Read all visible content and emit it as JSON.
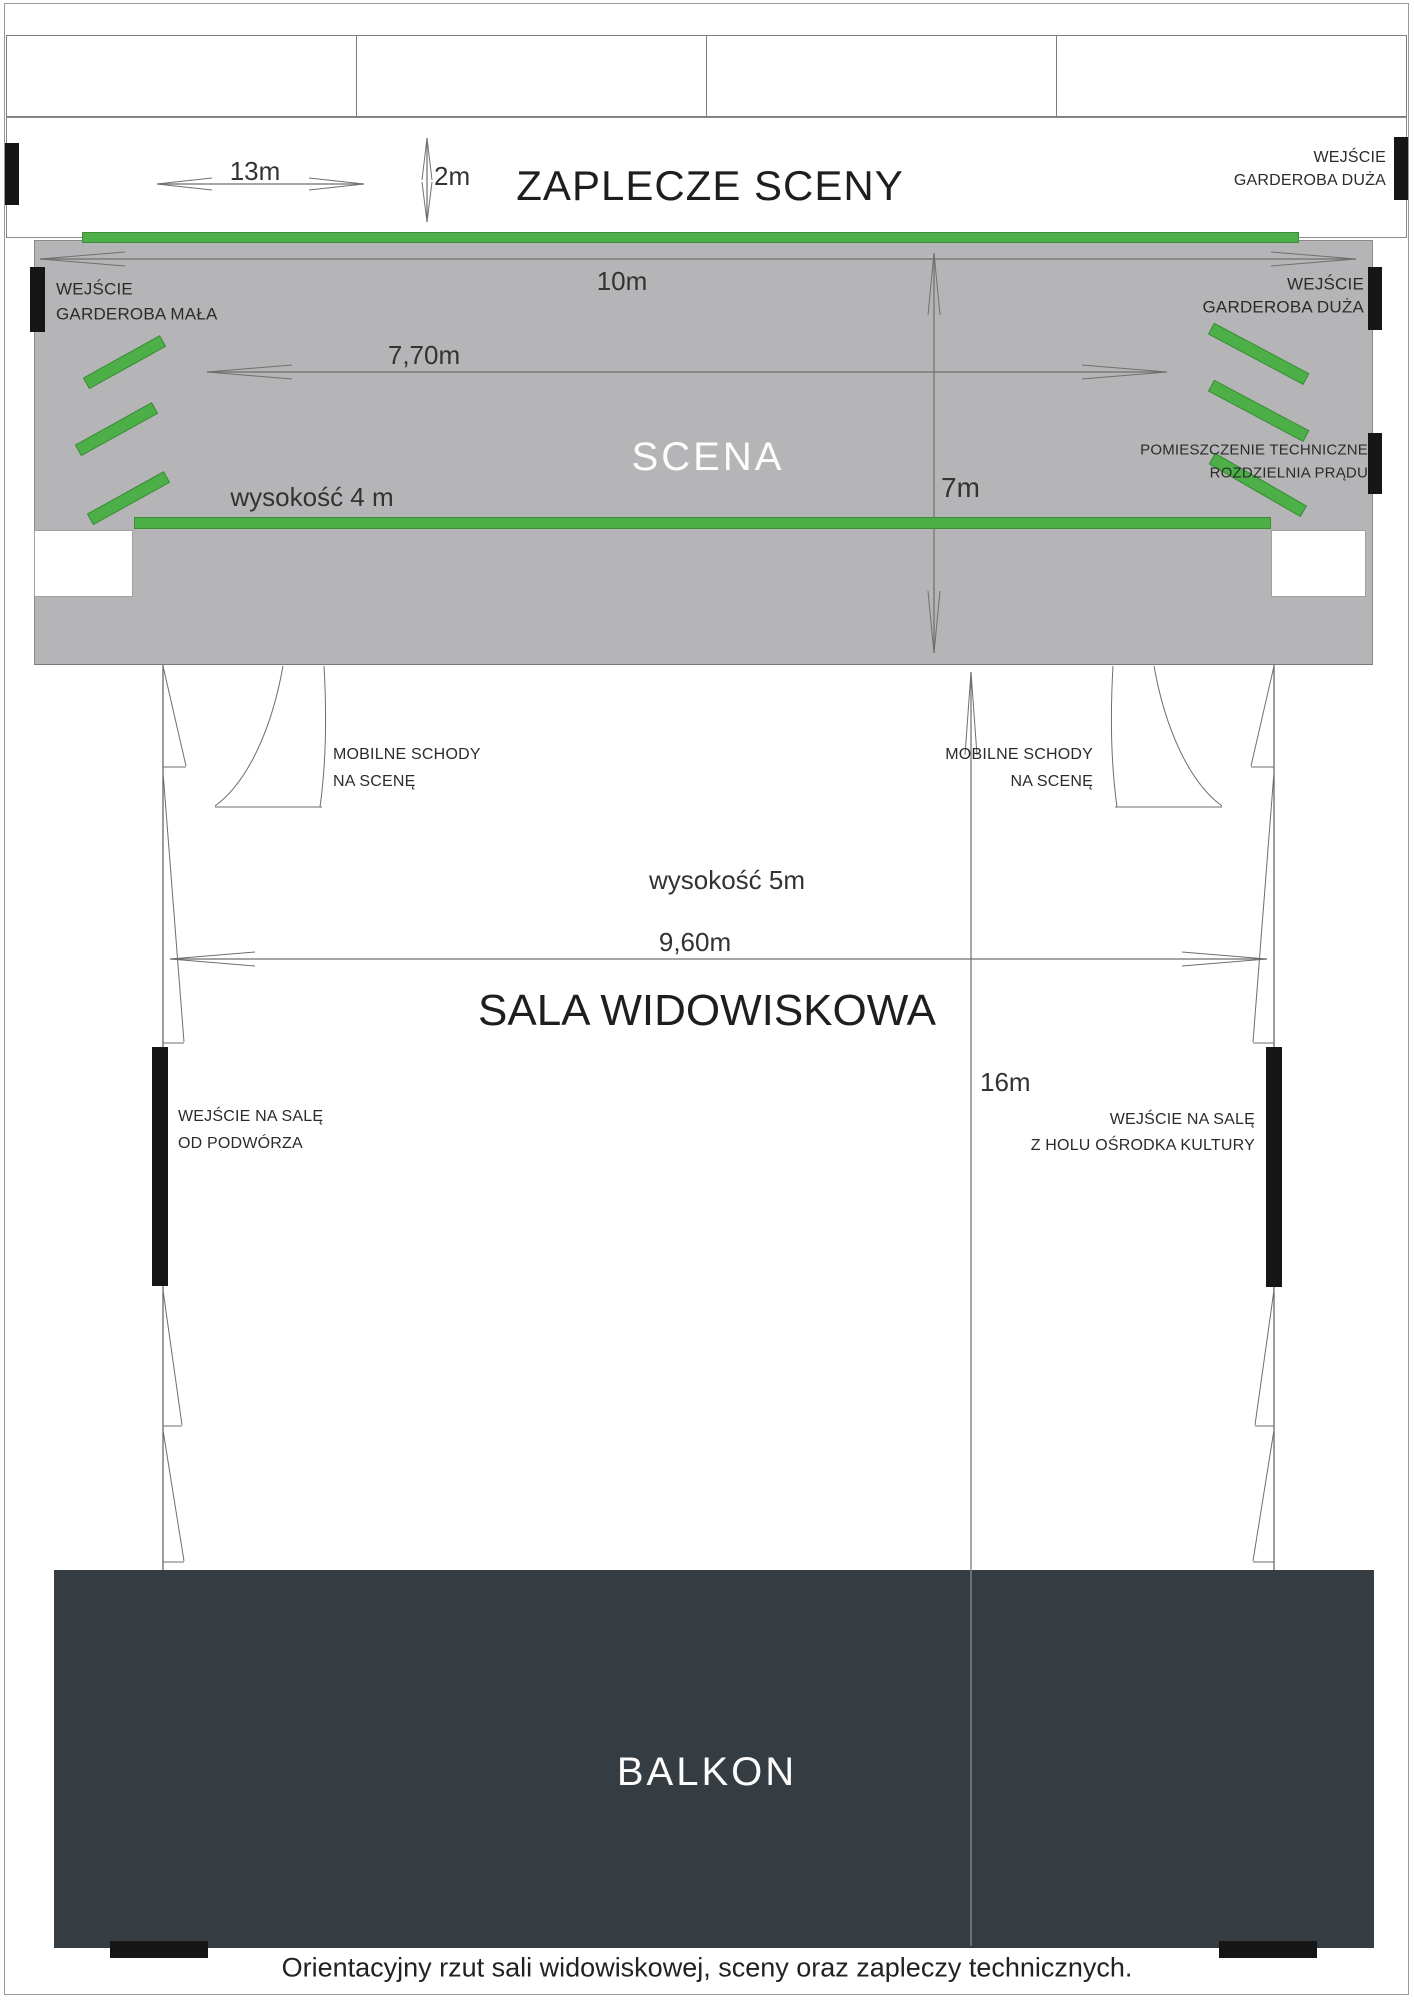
{
  "colors": {
    "stage_gray": "#b5b5b7",
    "curtain_green": "#4daf48",
    "curtain_green_border": "#3c8c38",
    "balcony_dark": "#363d42",
    "door_black": "#161616",
    "line_gray": "#6f6f6f",
    "border_gray": "#8a8a8a",
    "text_dark": "#2b2b2b"
  },
  "backstage": {
    "title": "ZAPLECZE SCENY",
    "width_label": "13m",
    "depth_label": "2m",
    "right_door_line1": "WEJŚCIE",
    "right_door_line2": "GARDEROBA DUŻA"
  },
  "stage": {
    "title": "SCENA",
    "width_label": "10m",
    "curtain_width_label": "7,70m",
    "depth_label": "7m",
    "height_label": "wysokość 4 m",
    "left_door_line1": "WEJŚCIE",
    "left_door_line2": "GARDEROBA MAŁA",
    "right_door_line1": "WEJŚCIE",
    "right_door_line2": "GARDEROBA DUŻA",
    "tech_line1": "POMIESZCZENIE TECHNICZNE",
    "tech_line2": "ROZDZIELNIA PRĄDU"
  },
  "hall": {
    "title": "SALA WIDOWISKOWA",
    "height_label": "wysokość 5m",
    "width_label": "9,60m",
    "length_label": "16m",
    "stairs_left_line1": "MOBILNE SCHODY",
    "stairs_left_line2": "NA SCENĘ",
    "stairs_right_line1": "MOBILNE SCHODY",
    "stairs_right_line2": "NA SCENĘ",
    "left_entrance_line1": "WEJŚCIE NA SALĘ",
    "left_entrance_line2": "OD PODWÓRZA",
    "right_entrance_line1": "WEJŚCIE NA SALĘ",
    "right_entrance_line2": "Z HOLU OŚRODKA KULTURY"
  },
  "balcony": {
    "title": "BALKON"
  },
  "caption": "Orientacyjny rzut sali widowiskowej, sceny oraz zapleczy technicznych."
}
